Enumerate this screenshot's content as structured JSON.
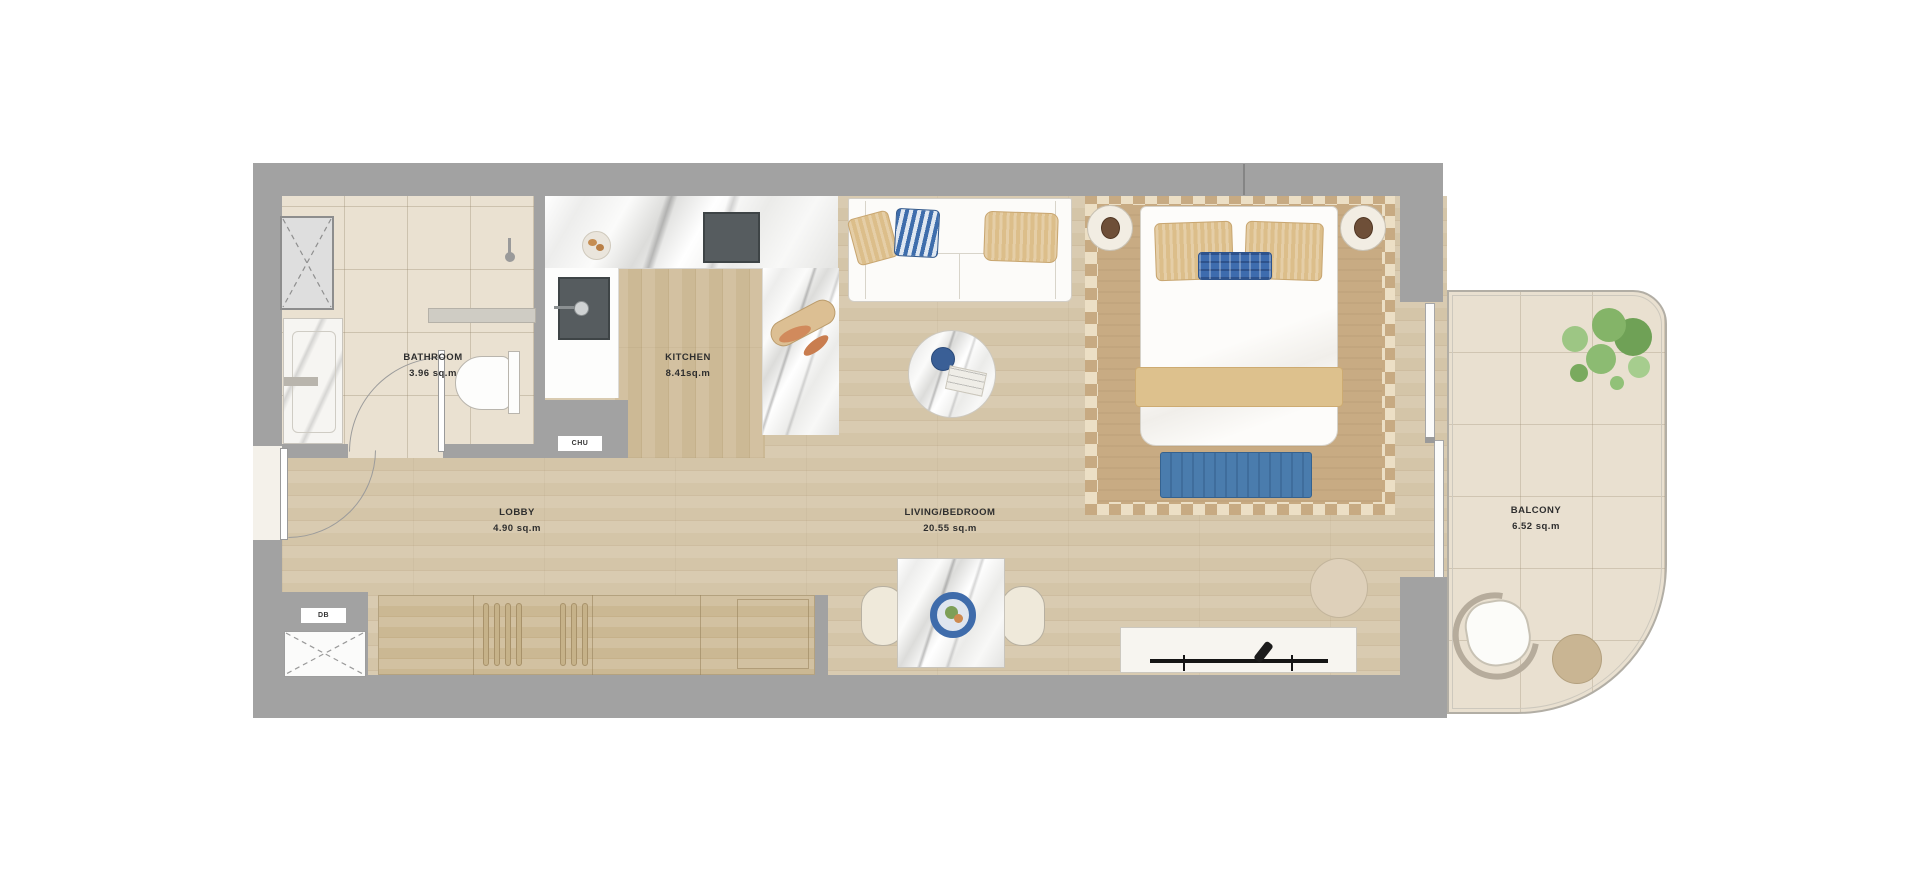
{
  "floorplan": {
    "rooms": [
      {
        "name": "BATHROOM",
        "area": "3.96 sq.m"
      },
      {
        "name": "KITCHEN",
        "area": "8.41sq.m"
      },
      {
        "name": "LOBBY",
        "area": "4.90 sq.m"
      },
      {
        "name": "LIVING/BEDROOM",
        "area": "20.55 sq.m"
      },
      {
        "name": "BALCONY",
        "area": "6.52 sq.m"
      }
    ],
    "utilities": [
      {
        "label": "CHU"
      },
      {
        "label": "DB"
      }
    ],
    "colors": {
      "wall_gray": "#a2a2a2",
      "wood_floor": "#d5c6a9",
      "tile_floor": "#eae1d1",
      "rug_tan": "#c8ab83",
      "rug_check_cream": "#ecdfc5",
      "accent_blue": "#4577a8",
      "pillow_tan": "#dcbe8a",
      "bench_blue": "#4a7cad",
      "plant_green": "#84b468",
      "marble_white": "#f6f6f5"
    },
    "icons": {
      "shaft_cross": "dashed-x",
      "door_swing": "quarter-arc"
    }
  }
}
